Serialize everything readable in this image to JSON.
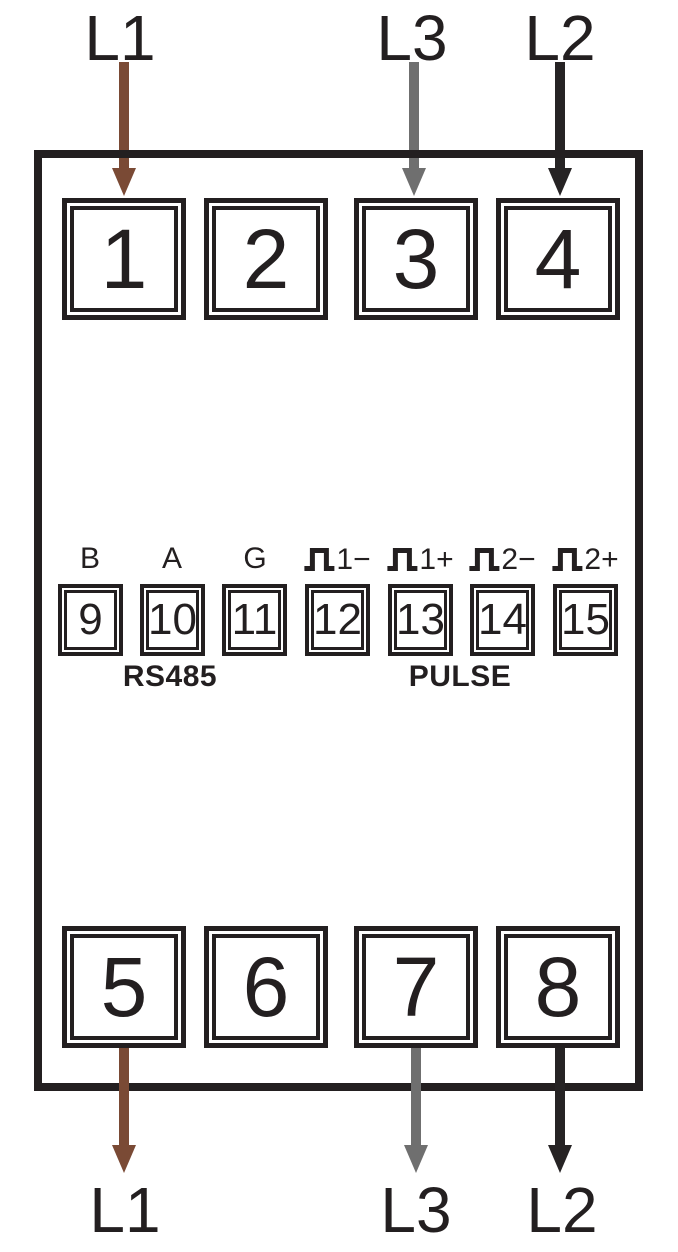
{
  "colors": {
    "line": "#231f20",
    "wire_brown": "#7a4a35",
    "wire_gray": "#6f6f6f",
    "wire_black": "#262324"
  },
  "top_connections": [
    {
      "phase": "L1",
      "wire": "wire_brown",
      "terminal": "1"
    },
    {
      "phase": "L3",
      "wire": "wire_gray",
      "terminal": "3"
    },
    {
      "phase": "L2",
      "wire": "wire_black",
      "terminal": "4"
    }
  ],
  "top_row_terminals": [
    "1",
    "2",
    "3",
    "4"
  ],
  "middle_row": {
    "terminals": [
      {
        "num": "9",
        "label": "B"
      },
      {
        "num": "10",
        "label": "A"
      },
      {
        "num": "11",
        "label": "G"
      },
      {
        "num": "12",
        "label": "1−",
        "icon": "pulse"
      },
      {
        "num": "13",
        "label": "1+",
        "icon": "pulse"
      },
      {
        "num": "14",
        "label": "2−",
        "icon": "pulse"
      },
      {
        "num": "15",
        "label": "2+",
        "icon": "pulse"
      }
    ],
    "rs485_label": "RS485",
    "pulse_label": "PULSE"
  },
  "bottom_row_terminals": [
    "5",
    "6",
    "7",
    "8"
  ],
  "bottom_connections": [
    {
      "phase": "L1",
      "wire": "wire_brown",
      "terminal": "5"
    },
    {
      "phase": "L3",
      "wire": "wire_gray",
      "terminal": "7"
    },
    {
      "phase": "L2",
      "wire": "wire_black",
      "terminal": "8"
    }
  ]
}
